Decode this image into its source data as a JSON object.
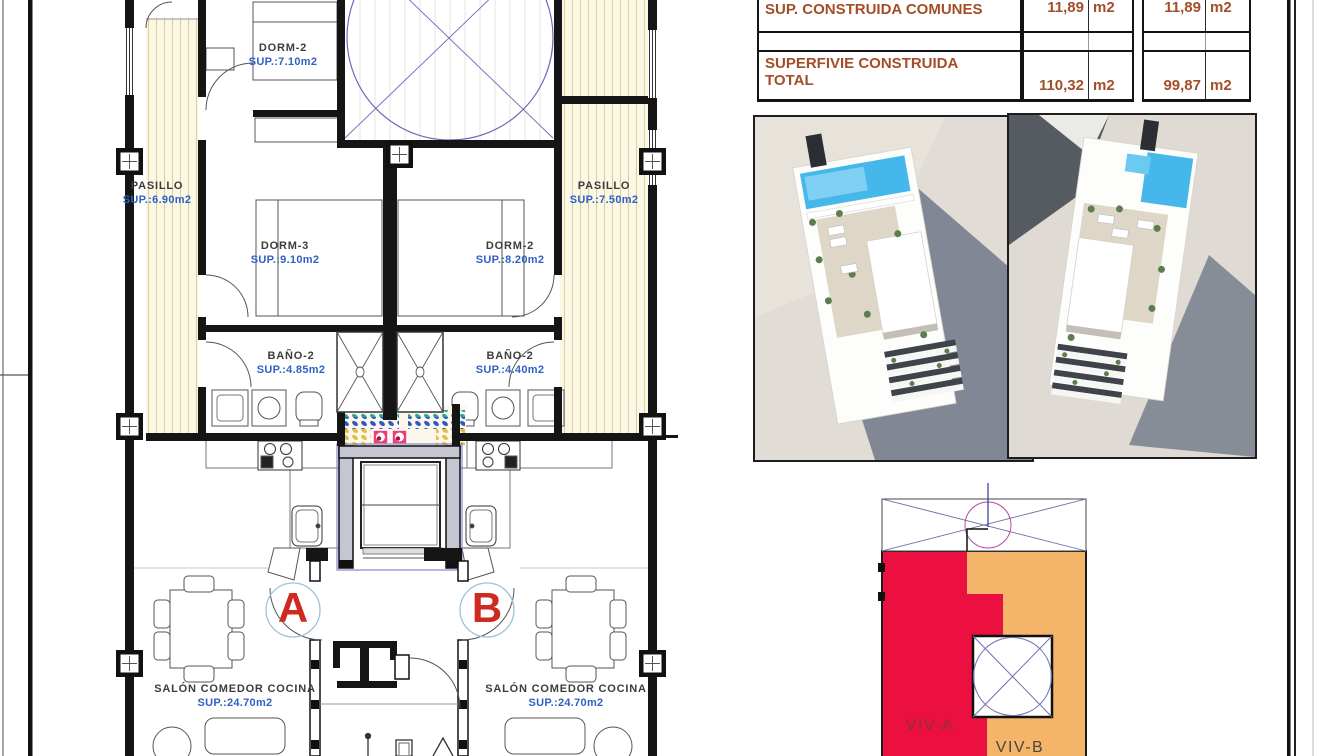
{
  "summary_table": {
    "r1": {
      "label": "SUP. CONSTRUIDA COMUNES",
      "v1": "11,89",
      "u1": "m2",
      "v2": "11,89",
      "u2": "m2"
    },
    "r3": {
      "label_line1": "SUPERFIVIE CONSTRUIDA",
      "label_line2": "TOTAL",
      "v1": "110,32",
      "u1": "m2",
      "v2": "99,87",
      "u2": "m2"
    }
  },
  "floorplan": {
    "rooms": {
      "dorm2_top": {
        "name": "DORM-2",
        "area": "SUP.:7.10m2"
      },
      "pasillo_left": {
        "name": "PASILLO",
        "area": "SUP.:6.90m2"
      },
      "pasillo_right": {
        "name": "PASILLO",
        "area": "SUP.:7.50m2"
      },
      "dorm3": {
        "name": "DORM-3",
        "area": "SUP.:9.10m2"
      },
      "dorm2_right": {
        "name": "DORM-2",
        "area": "SUP.:8.20m2"
      },
      "bano_left": {
        "name": "BAÑO-2",
        "area": "SUP.:4.85m2"
      },
      "bano_right": {
        "name": "BAÑO-2",
        "area": "SUP.:4.40m2"
      },
      "salon_left": {
        "name": "SALÓN COMEDOR COCINA",
        "area": "SUP.:24.70m2"
      },
      "salon_right": {
        "name": "SALÓN COMEDOR COCINA",
        "area": "SUP.:24.70m2"
      }
    },
    "unit_a": "A",
    "unit_b": "B"
  },
  "viv_diagram": {
    "viv_a_label": "VIV-A",
    "viv_b_label": "VIV-B"
  },
  "colors": {
    "viv_a_fill": "#ec1040",
    "viv_b_fill": "#f4b469",
    "room_text": "#3c3c3c",
    "area_text": "#2f62c4",
    "table_text": "#a34e28",
    "entrance_letter": "#cf2a20",
    "pool_blue": "#45b7ea",
    "tile_teal": "#23a598",
    "tile_blue": "#2d58c8",
    "tile_yellow": "#e3bf3d",
    "tile_pink": "#ee3e77",
    "hatch_cream": "#fcf8e6"
  }
}
